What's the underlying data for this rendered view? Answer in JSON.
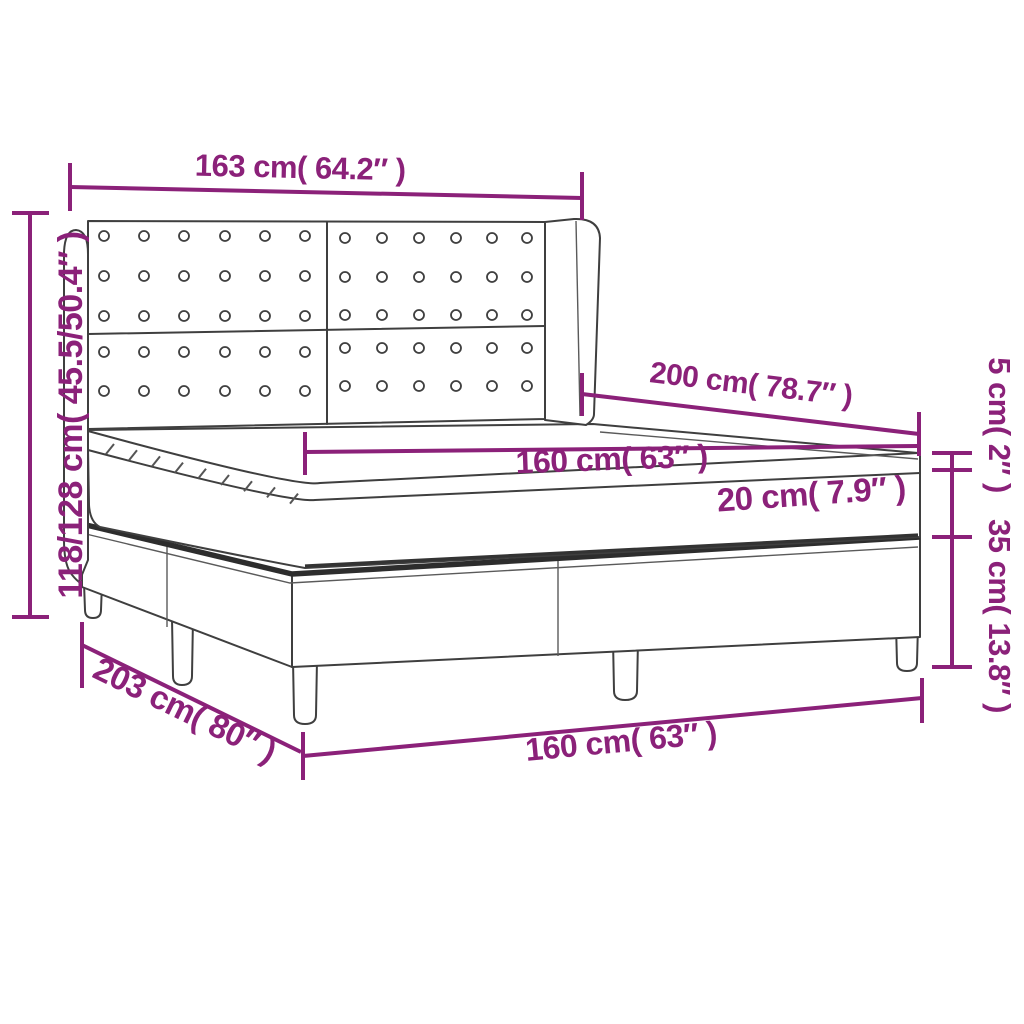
{
  "diagram": {
    "type": "product-dimension-diagram",
    "subject": "box spring bed with tufted winged headboard",
    "accent_color": "#8b2179",
    "line_color": "#3f3f3f",
    "labels": {
      "headboard_width": "163 cm( 64.2″ )",
      "overall_height": "118/128 cm( 45.5/50.4″ )",
      "mattress_length": "200 cm( 78.7″ )",
      "mattress_width": "160 cm( 63″ )",
      "pillow_top_height": "5 cm( 2″ )",
      "mattress_height": "20 cm( 7.9″ )",
      "base_height": "35 cm( 13.8″ )",
      "base_length": "203 cm( 80″ )",
      "base_width": "160 cm( 63″ )"
    }
  }
}
